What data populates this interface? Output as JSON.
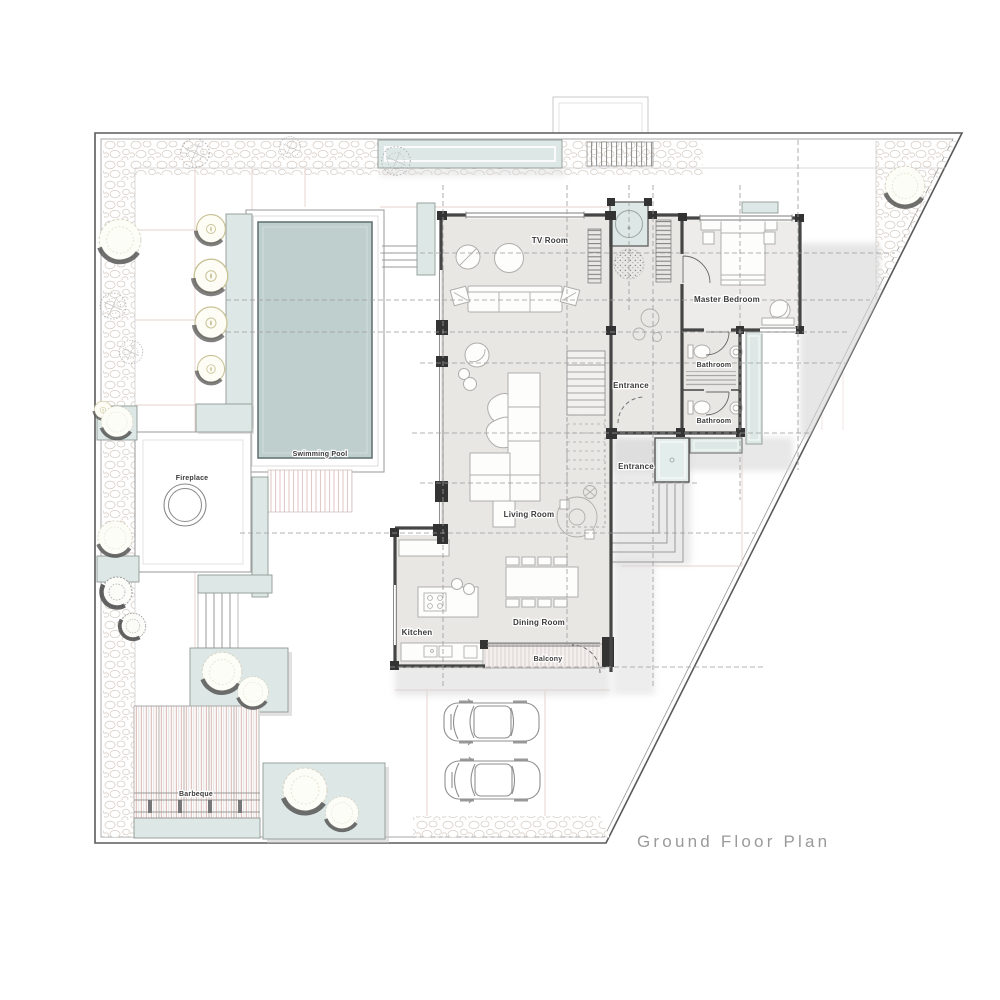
{
  "title": "Ground Floor Plan",
  "plan": {
    "rooms": {
      "tv_room": "TV Room",
      "master_bedroom": "Master Bedroom",
      "bathroom_1": "Bathroom",
      "bathroom_2": "Bathroom",
      "entrance_upper": "Entrance",
      "entrance_lower": "Entrance",
      "living_room": "Living Room",
      "kitchen": "Kitchen",
      "dining_room": "Dining Room",
      "balcony": "Balcony"
    },
    "outdoor": {
      "swimming_pool": "Swimming Pool",
      "fireplace": "Fireplace",
      "barbeque": "Barbeque"
    }
  },
  "icons": {
    "trees": "tree-icon",
    "cars": "car-icon",
    "fireplace_pit": "fireplace-circle-icon",
    "stairs": "stairs-icon"
  },
  "colors": {
    "pool": "#becfce",
    "planter": "#dde8e6",
    "floor": "#e9e7e4",
    "floor_bedroom": "#eeecea",
    "wall": "#454545",
    "wall_dark": "#333333",
    "shadow": "#d6d6d6",
    "pebble": "#d9d0c9",
    "path": "#e6d2cd",
    "stripe": "#e0c9c4",
    "furniture": "#b0aeab",
    "line": "#9b9b9b",
    "label": "#3a3a3a",
    "title": "#9a9a9a"
  }
}
